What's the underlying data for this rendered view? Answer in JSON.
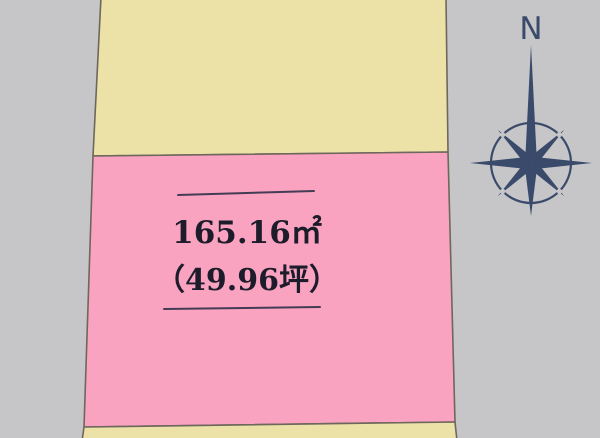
{
  "colors": {
    "background": "#c6c5c7",
    "parcel_cream": "#ece2a7",
    "parcel_pink": "#f9a3c0",
    "parcel_border": "#6e675c",
    "dimension_line": "#443c55",
    "label_text": "#1d1c2a",
    "compass_navy": "#3a4a6b"
  },
  "parcel": {
    "area_m2": "165.16㎡",
    "area_tsubo": "（49.96坪）"
  },
  "compass": {
    "north_label": "N"
  }
}
